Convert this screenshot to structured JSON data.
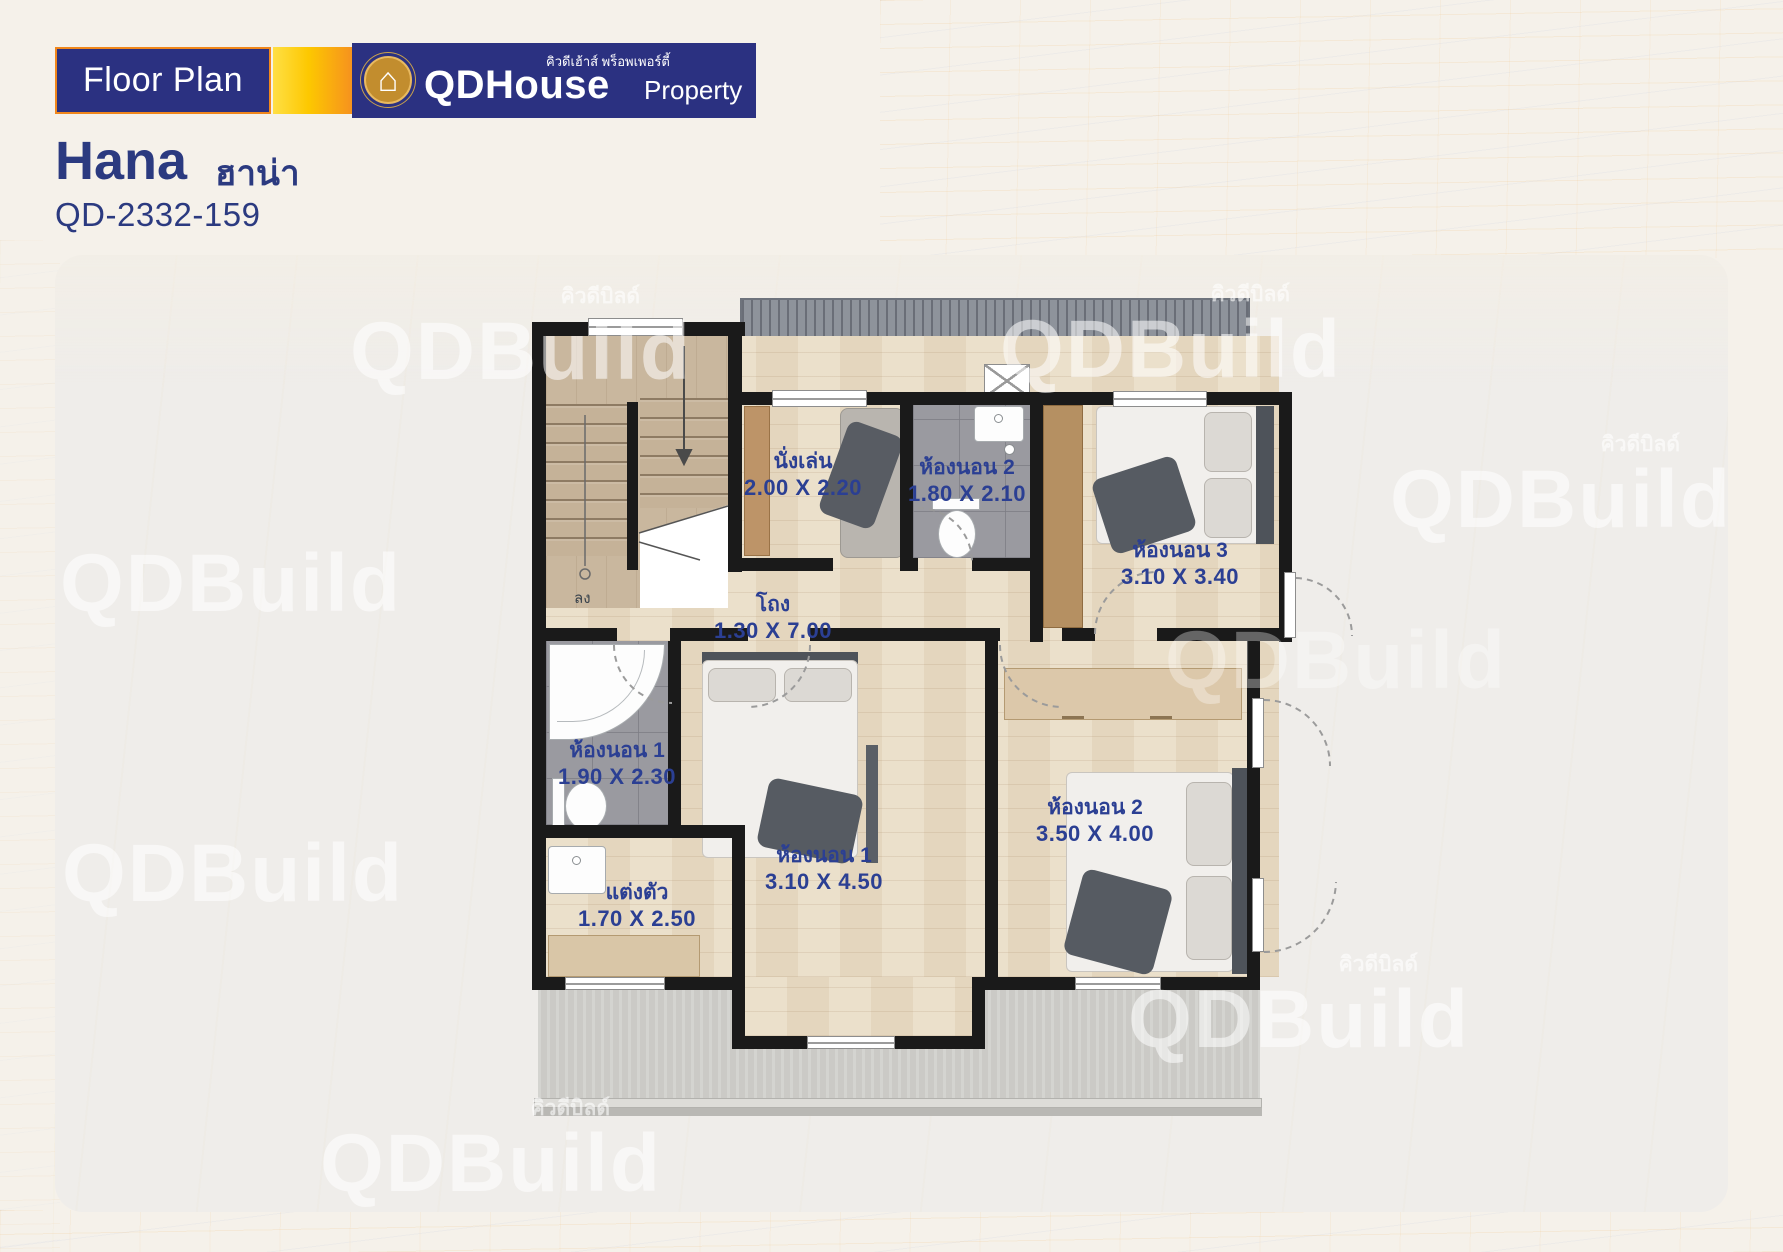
{
  "header": {
    "badge_label": "Floor Plan",
    "logo": {
      "thai_tagline": "คิวดีเฮ้าส์ พร็อพเพอร์ตี้",
      "brand_main": "QDHouse",
      "brand_sub": "Property",
      "icon": "house-icon"
    },
    "plan_name": "Hana",
    "plan_name_thai": "ฮาน่า",
    "plan_code": "QD-2332-159"
  },
  "watermark": {
    "brand": "QDBuild",
    "thai": "คิวดีบิลด์"
  },
  "floorplan": {
    "stairs_down_label": "ลง",
    "rooms": [
      {
        "name": "นั่งเล่น",
        "size": "2.00 X 2.20"
      },
      {
        "name": "ห้องนอน 2",
        "size": "1.80 X 2.10"
      },
      {
        "name": "ห้องนอน 3",
        "size": "3.10 X 3.40"
      },
      {
        "name": "โถง",
        "size": "1.30 X 7.00"
      },
      {
        "name": "ห้องนอน 1",
        "size": "1.90 X 2.30"
      },
      {
        "name": "แต่งตัว",
        "size": "1.70 X 2.50"
      },
      {
        "name": "ห้องนอน 1",
        "size": "3.10 X 4.50"
      },
      {
        "name": "ห้องนอน 2",
        "size": "3.50 X 4.00"
      }
    ]
  },
  "colors": {
    "navy": "#2b3181",
    "title_navy": "#2b3a80",
    "label_blue": "#2b3f93",
    "orange": "#f6921e",
    "yellow": "#fdc800",
    "gold": "#c28d2e",
    "wall": "#1a1a1a",
    "wood_floor": "#e9dcc5",
    "tile_gray": "#9a9aa0",
    "roof_gray": "#8e939b",
    "balcony_concrete": "#cbcac6"
  }
}
